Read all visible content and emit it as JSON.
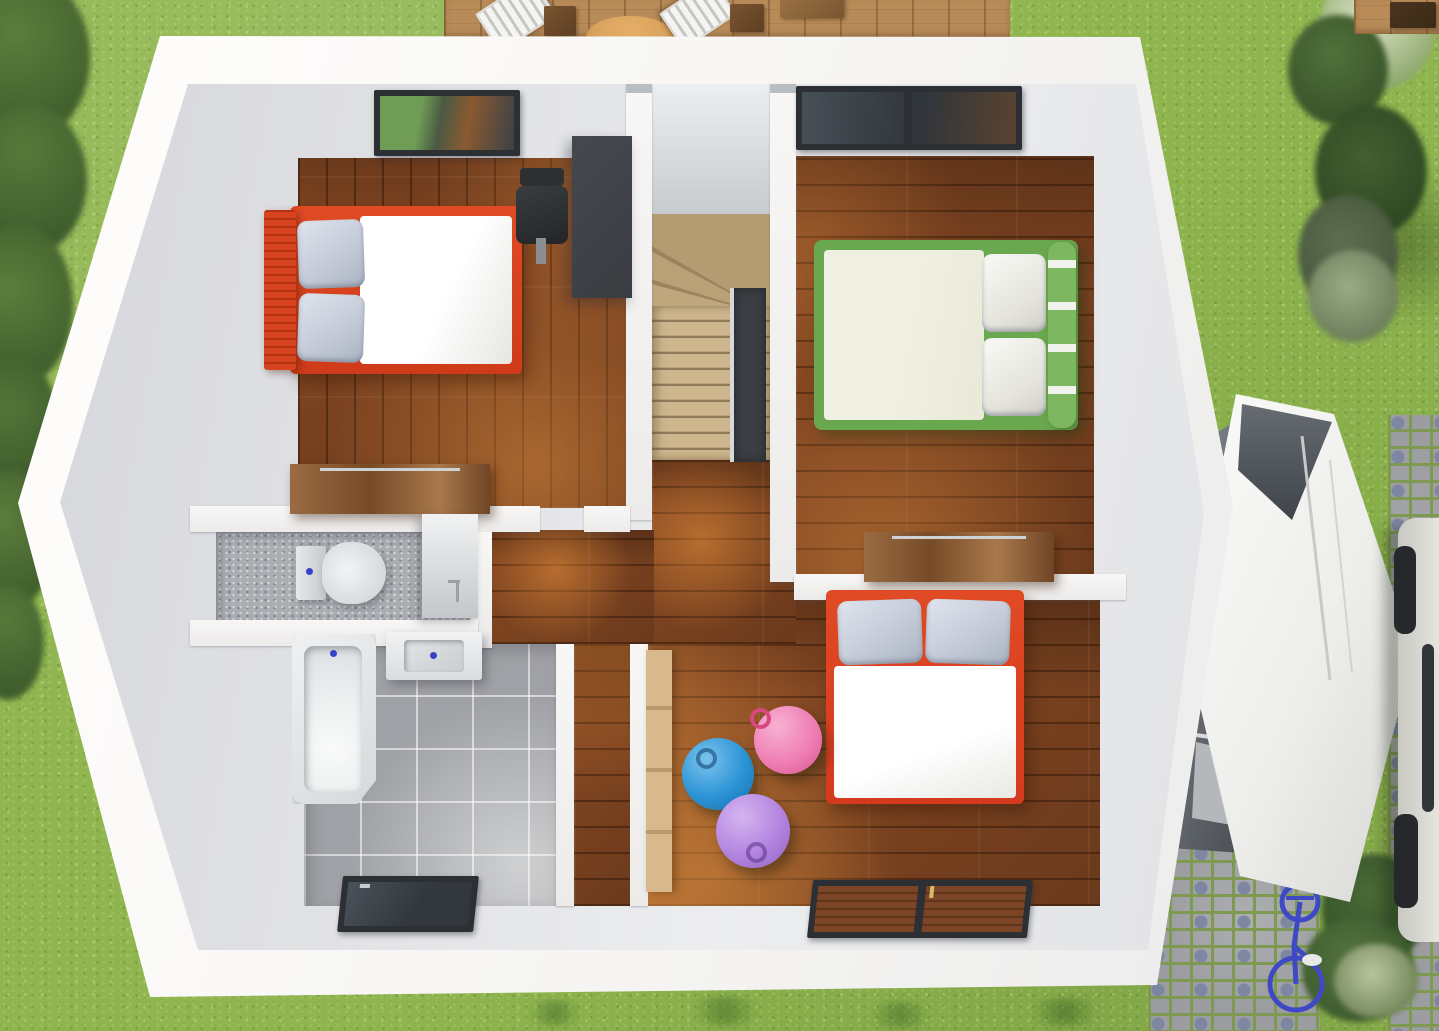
{
  "scene": {
    "description": "Top-down 3D architectural render of a house upper floor (dollhouse cutaway) in a garden",
    "house": {
      "rooms": [
        {
          "name": "bedroom-1",
          "position": "top-left",
          "floor": "wood-planks",
          "objects": [
            "double-bed-red-frame",
            "gray-pillows-x2",
            "white-duvet",
            "desk-dark",
            "office-chair",
            "wood-dresser",
            "skylight-window"
          ]
        },
        {
          "name": "bedroom-2",
          "position": "top-right",
          "floor": "wood-planks",
          "objects": [
            "double-bed-green-frame",
            "cream-duvet",
            "white-pillows-x2",
            "wood-dresser",
            "skylight-window"
          ]
        },
        {
          "name": "kids-bedroom",
          "position": "bottom-right",
          "floor": "wood-planks",
          "objects": [
            "bed-red-frame",
            "gray-pillows-x2",
            "white-duvet",
            "wardrobe-tan",
            "exercise-ball-blue",
            "exercise-ball-pink",
            "exercise-ball-purple",
            "window"
          ]
        },
        {
          "name": "wc",
          "position": "middle-left",
          "floor": "gray-speckle",
          "objects": [
            "toilet",
            "vanity-cabinet-with-faucet"
          ]
        },
        {
          "name": "bathroom",
          "position": "bottom-left",
          "floor": "gray-tile",
          "objects": [
            "bathtub",
            "washbasin",
            "window"
          ]
        },
        {
          "name": "staircase",
          "position": "center",
          "objects": [
            "winder-stairs",
            "stair-void-panel"
          ]
        },
        {
          "name": "hallway-landing",
          "position": "center",
          "floor": "wood-planks",
          "objects": []
        }
      ]
    },
    "garden": {
      "objects": [
        "lawn",
        "hedge-left",
        "flowering-tree-strip-right",
        "wood-deck-top",
        "deck-chairs-white-x2",
        "deck-side-tables",
        "parasol-tan",
        "deck-top-right",
        "garage-annex",
        "garage-passage",
        "cobblestone-paths",
        "white-car-right-edge",
        "blue-bicycle",
        "bush-cluster-bottom-right",
        "grass-plants-bottom"
      ]
    }
  },
  "colors": {
    "grass-base": "#8fb54e",
    "hedge-dark": "#4a6b33",
    "tree-dark": "#3d5c2f",
    "flower-pale": "#dde5c8",
    "deck-wood": "#b88b58",
    "parasol-tan": "#d9a35f",
    "wall-white": "#f7f6f4",
    "plate-gray": "#dfe0e3",
    "floor-wood": "#8a4a24",
    "sun-orange": "#e08a3c",
    "tile": "#9fa1a6",
    "wc-floor": "#aaadb2",
    "stair-wood": "#c9b189",
    "stair-dark": "#9d845f",
    "void-dark": "#3b3e43",
    "bed1-frame": "#cf3b1a",
    "pillow-gray": "#c2c9d6",
    "duvet-white": "#f7f6f3",
    "bed2-frame": "#6aa84f",
    "duvet-cream": "#e9e9d8",
    "kids-frame": "#d63a1e",
    "ball-blue": "#2b93d6",
    "ball-pink": "#ef7fb4",
    "ball-purple": "#b385e0",
    "wardrobe-tan": "#d8b88c",
    "fixture-white": "#eef0f1",
    "drain-blue": "#3742c8",
    "window-frame": "#2c2f33",
    "glass-dark": "#3f464d",
    "cobble-stone": "#9b9da0",
    "cobble-blue": "#7e87a2",
    "cobble-grout": "#7d9a50",
    "garage-dark": "#44494e",
    "car-body": "#d9d9d3",
    "car-dark": "#26282b",
    "bike-blue": "#3f49c4",
    "desk-dark": "#3a3d41",
    "dresser-wood": "#8a5c36"
  }
}
